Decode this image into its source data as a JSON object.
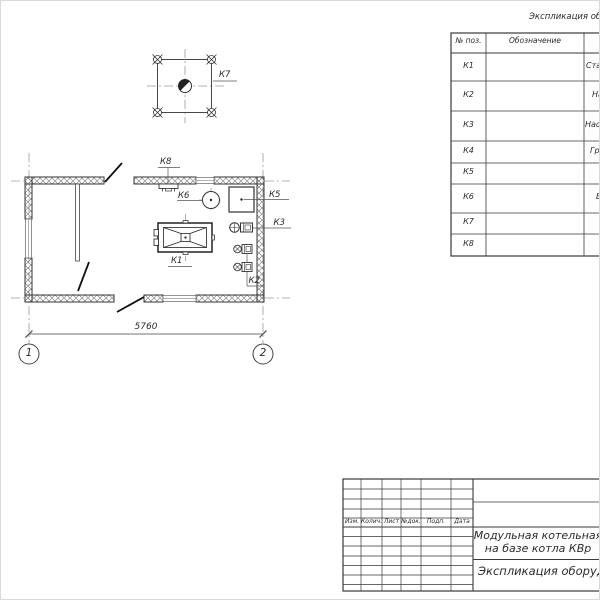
{
  "plan": {
    "labels": {
      "k1": "К1",
      "k2": "К2",
      "k3": "К3",
      "k5": "К5",
      "k6": "К6",
      "k7": "К7",
      "k8": "К8"
    },
    "dimension_width": "5760",
    "axis_bubbles": [
      "1",
      "2"
    ]
  },
  "equipment_table": {
    "title": "Экспликация оборудования",
    "columns": {
      "pos": "№ поз.",
      "designation": "Обозначение"
    },
    "rows": [
      {
        "pos": "К1",
        "name": "Стал"
      },
      {
        "pos": "К2",
        "name": "На"
      },
      {
        "pos": "К3",
        "name": "Насос"
      },
      {
        "pos": "К4",
        "name": "Гр"
      },
      {
        "pos": "К5",
        "name": ""
      },
      {
        "pos": "К6",
        "name": "Б"
      },
      {
        "pos": "К7",
        "name": ""
      },
      {
        "pos": "К8",
        "name": ""
      }
    ]
  },
  "title_block": {
    "columns": [
      "Изм.",
      "Колич.",
      "Лист",
      "№док.",
      "Подп.",
      "Дата"
    ],
    "project_line1": "Модульная котельная",
    "project_line2": "на базе котла КВр",
    "sheet_name": "Экспликация оборудования"
  }
}
